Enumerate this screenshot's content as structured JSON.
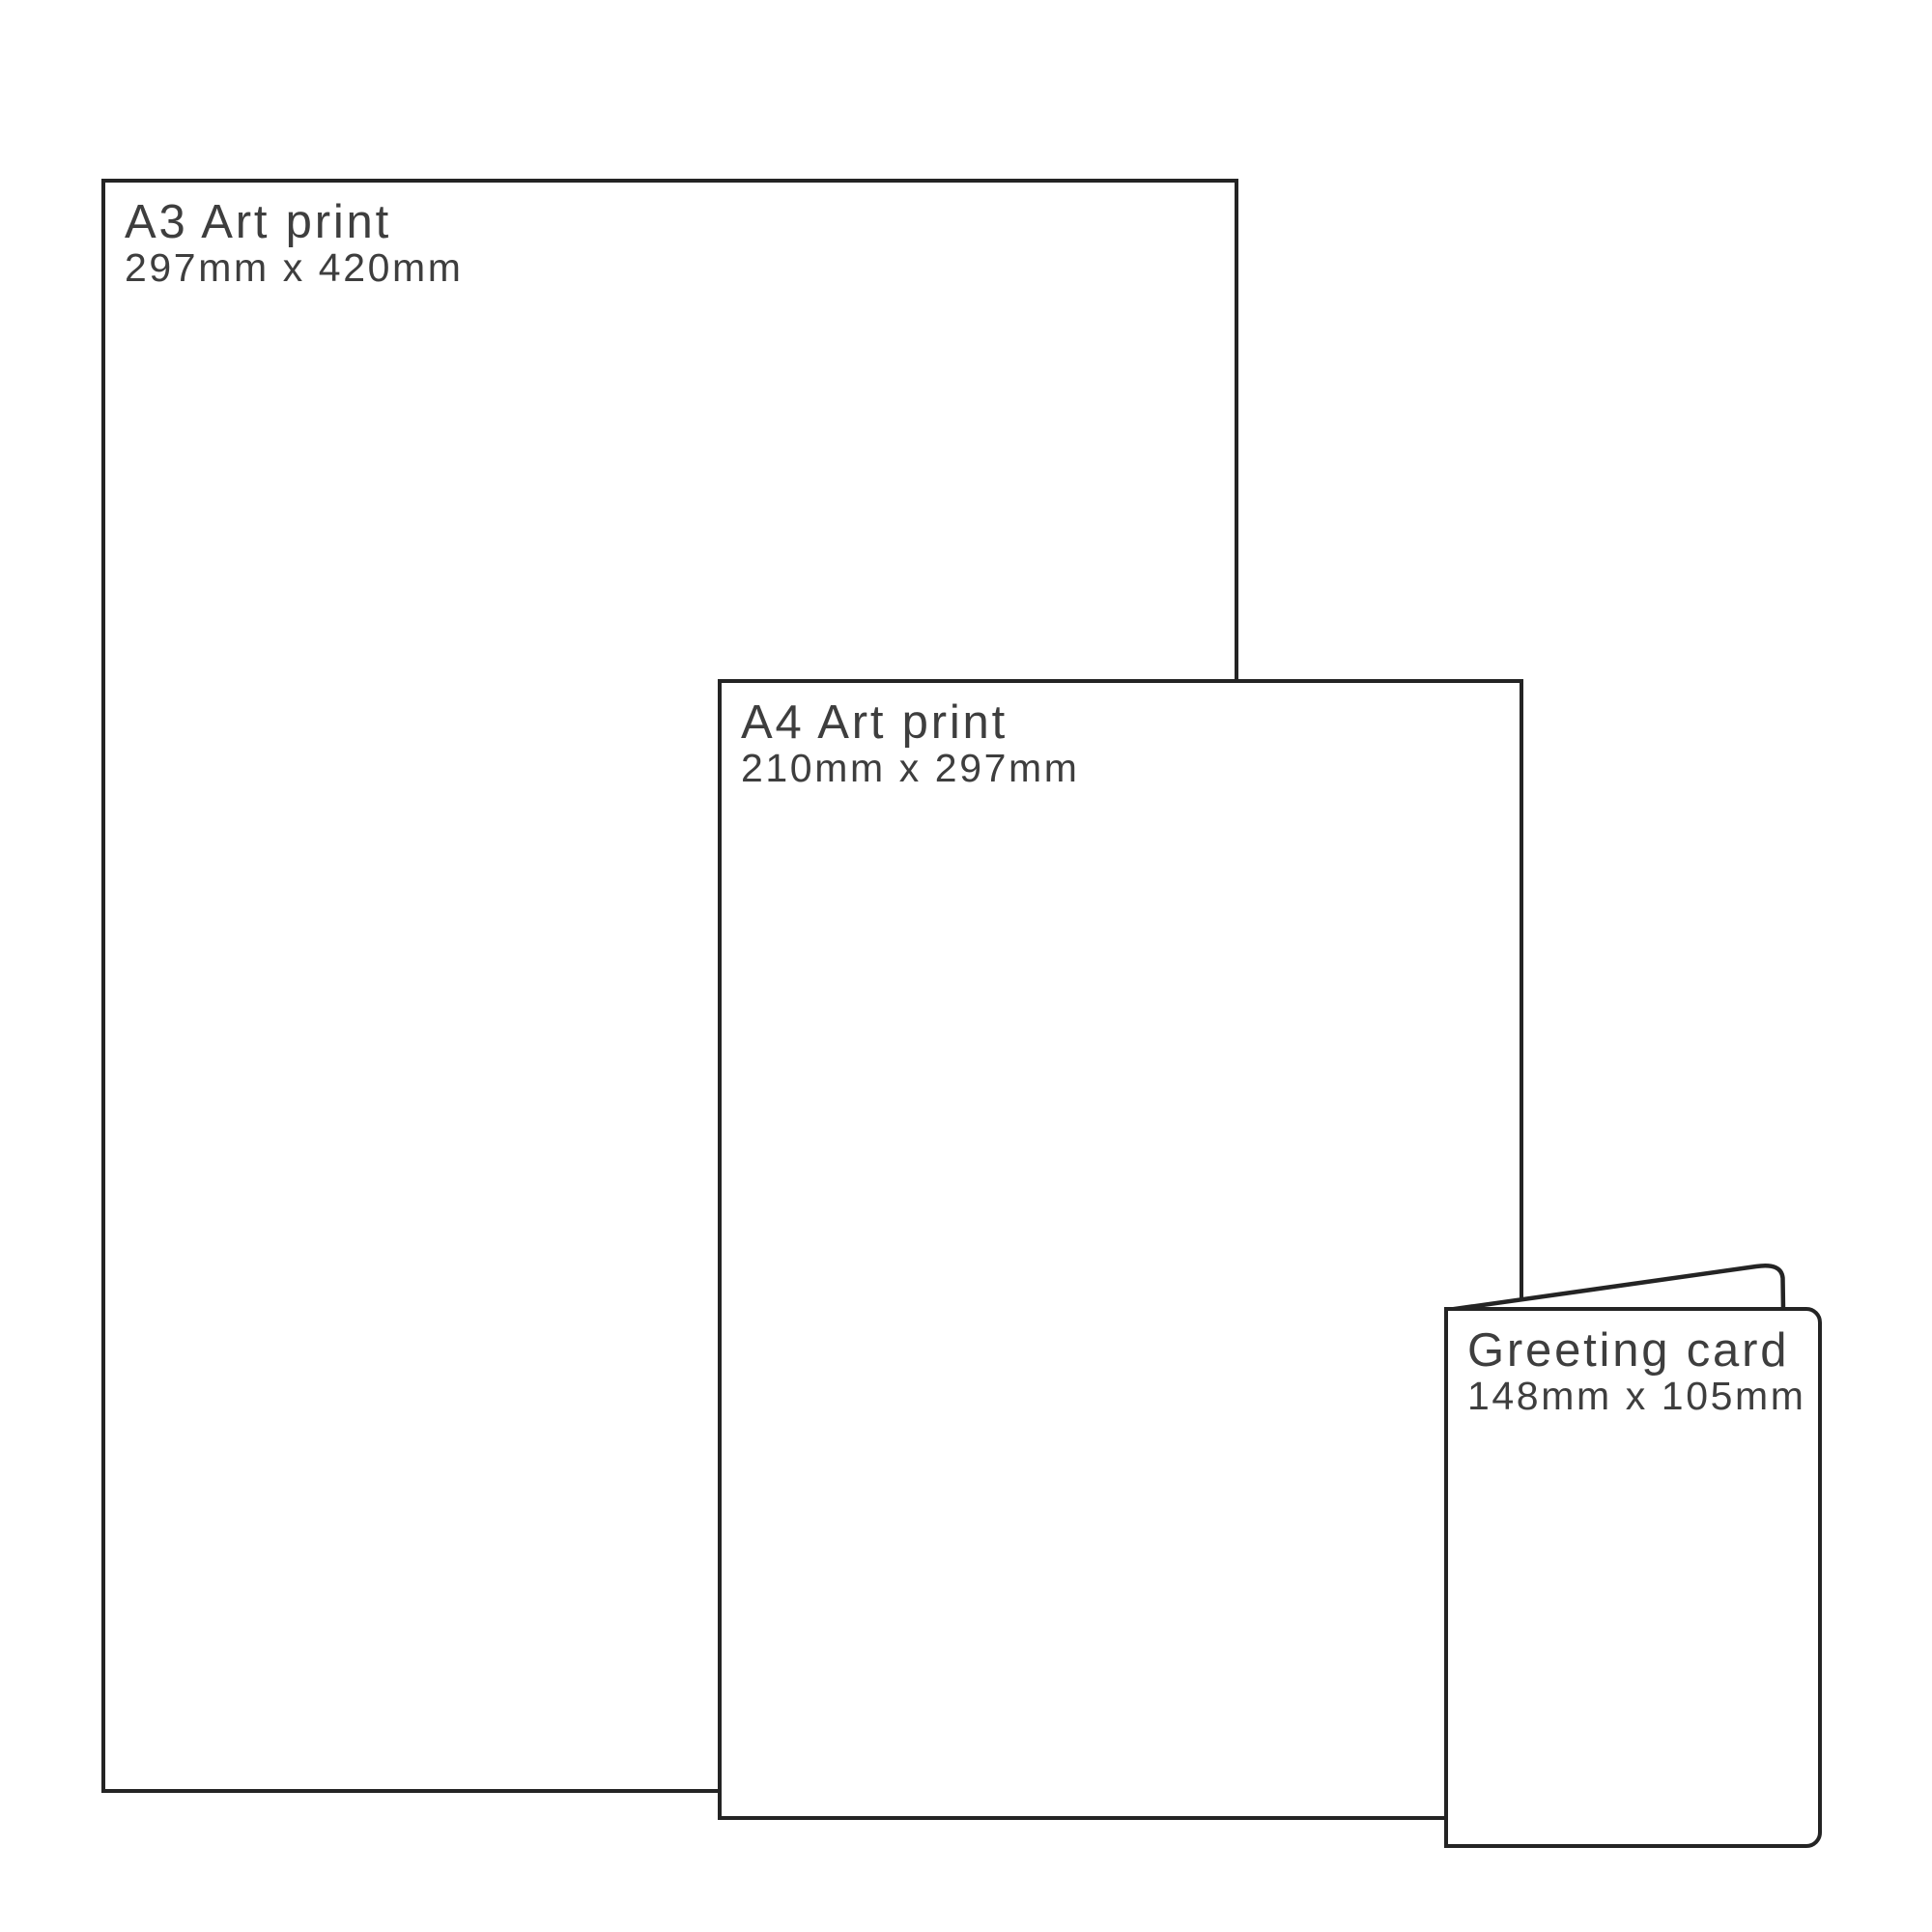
{
  "colors": {
    "line": "#242424",
    "text": "#3e3e3e",
    "surface": "#ffffff"
  },
  "items": [
    {
      "name": "a3-art-print",
      "label": "A3 Art print",
      "dimensions": "297mm x 420mm"
    },
    {
      "name": "a4-art-print",
      "label": "A4 Art print",
      "dimensions": "210mm x 297mm"
    },
    {
      "name": "greeting-card",
      "label": "Greeting card",
      "dimensions": "148mm x 105mm"
    }
  ]
}
